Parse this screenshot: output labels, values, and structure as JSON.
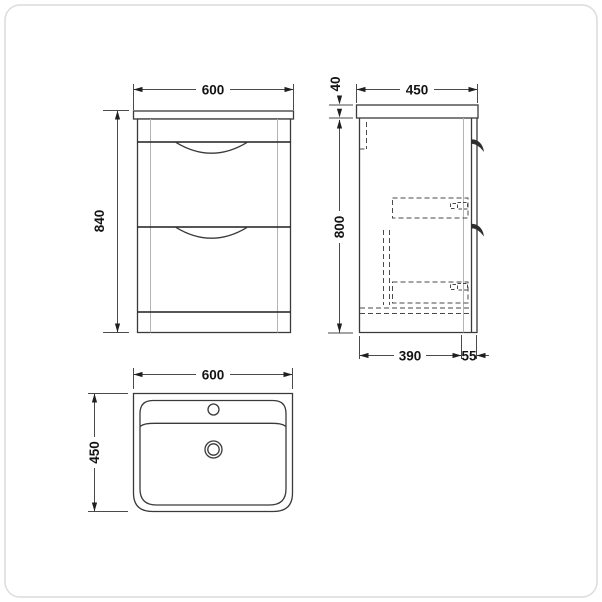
{
  "colors": {
    "background": "#ffffff",
    "main_line": "#3a3a3a",
    "strong_line": "#1f1f1f",
    "light_line": "#b4b4b4",
    "dashed_line": "#4a4a4a",
    "dimension_text": "#141414",
    "frame_border": "#dcdcdc"
  },
  "views": {
    "front_elevation": {
      "width_mm": "600",
      "height_mm": "840"
    },
    "side_elevation": {
      "worktop_thickness_mm": "40",
      "depth_mm": "450",
      "cabinet_height_mm": "800",
      "carcass_depth_mm": "390",
      "front_projection_mm": "55"
    },
    "plan_view": {
      "width_mm": "600",
      "depth_mm": "450"
    }
  }
}
